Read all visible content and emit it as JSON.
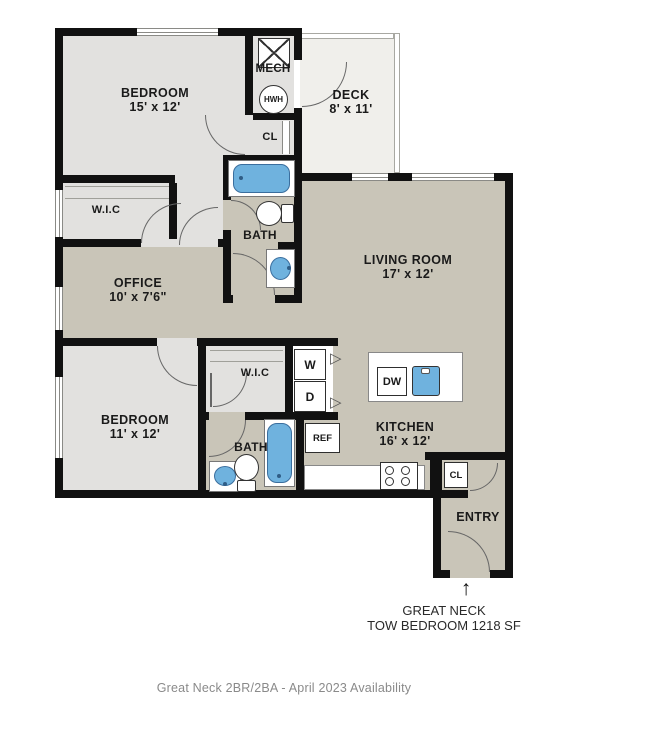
{
  "rooms": {
    "bedroom1": {
      "name": "BEDROOM",
      "dims": "15' x 12'"
    },
    "deck": {
      "name": "DECK",
      "dims": "8' x 11'"
    },
    "office": {
      "name": "OFFICE",
      "dims": "10' x 7'6\""
    },
    "living_room": {
      "name": "LIVING ROOM",
      "dims": "17' x 12'"
    },
    "bedroom2": {
      "name": "BEDROOM",
      "dims": "11' x 12'"
    },
    "kitchen": {
      "name": "KITCHEN",
      "dims": "16' x 12'"
    }
  },
  "labels": {
    "mech": "MECH",
    "water_heater": "HWH",
    "closet_top": "CL",
    "wic_top": "W.I.C",
    "bath_top": "BATH",
    "wic_bottom": "W.I.C",
    "bath_bottom": "BATH",
    "washer": "W",
    "dryer": "D",
    "dishwasher": "DW",
    "refrigerator": "REF",
    "closet_kitchen": "CL",
    "entry": "ENTRY"
  },
  "annotation": {
    "arrow": "↑",
    "line1": "GREAT NECK",
    "line2": "TOW BEDROOM 1218 SF"
  },
  "caption": "Great Neck 2BR/2BA - April 2023 Availability",
  "colors": {
    "wall": "#111111",
    "floor_light": "#e2e1df",
    "floor_dark": "#c9c5b8",
    "deck_floor": "#f0efeb",
    "fixture_blue": "#6fb2de",
    "caption_gray": "#8a8a8a"
  }
}
